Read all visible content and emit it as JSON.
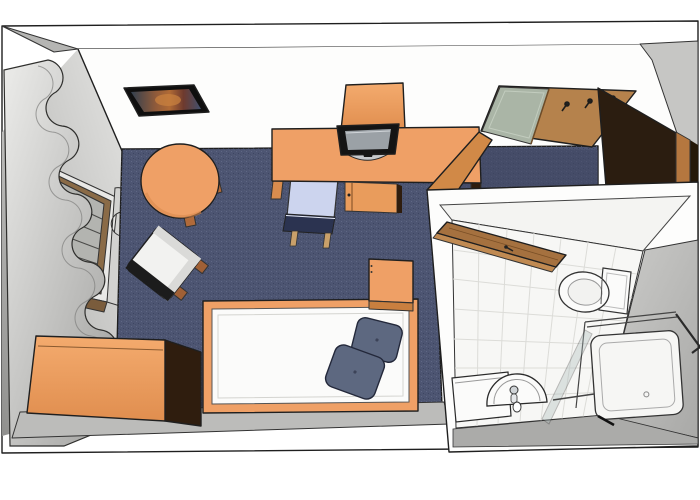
{
  "scene": {
    "title": "3D top-down floor plan render of a single room with en-suite bathroom",
    "style": "sketchup-like architectural rendering, bird's-eye perspective",
    "rooms": [
      "main-room",
      "bathroom"
    ]
  },
  "palette": {
    "outline": "#1f1f1f",
    "wall_white": "#fdfdfc",
    "wall_gray": "#c9c9c7",
    "wall_gray_dark": "#8f8f8d",
    "south_wall": "#bcbcba",
    "carpet": "#4d5572",
    "carpet_shadow": "#3f4661",
    "wood": "#efa066",
    "wood_dark": "#d18947",
    "wood_side": "#2f1d0e",
    "door_dark": "#2b1d10",
    "door_edge": "#b5773f",
    "bath_door": "#a5713f",
    "mirror_green": "#aab5a6",
    "curtain": "#d9d9d7",
    "window_frame": "#8a6b47",
    "window_glass": "#b3b4b0",
    "pillow": "#5d6880",
    "bedding": "#fbfbfa",
    "chair_seat": "#ccd4ee",
    "chair_back": "#2b3350",
    "armchair_white": "#f2f2f0",
    "armchair_band": "#1c1c1c",
    "tv_body": "#141414",
    "tv_screen": "#9ba1a6",
    "tv_base": "#c6c9cd",
    "tile": "#f7f7f5",
    "tile_line": "#dcdcd8",
    "fixture_white": "#fbfbfa",
    "picture_frame": "#0f0f0f"
  },
  "main_room": {
    "floor": "dark blue carpet",
    "items": [
      {
        "name": "wall-picture",
        "desc": "framed colorful picture on north wall"
      },
      {
        "name": "round-table",
        "desc": "round wooden table"
      },
      {
        "name": "armchair",
        "desc": "white lounge chair, rotated"
      },
      {
        "name": "window",
        "desc": "window with blinds and wavy curtains on west wall"
      },
      {
        "name": "sideboard",
        "desc": "orange chest at south-west corner"
      },
      {
        "name": "bed",
        "desc": "single bed, white bedding, two slate pillows"
      },
      {
        "name": "nightstand",
        "desc": "cube bedside table"
      },
      {
        "name": "desk",
        "desc": "long desk with TV, cabinet and shelf"
      },
      {
        "name": "desk-chair",
        "desc": "chair tucked under desk"
      },
      {
        "name": "coat-rack",
        "desc": "wall board with mirror and three hooks"
      },
      {
        "name": "luggage-bench",
        "desc": "wooden bench below coat rack"
      },
      {
        "name": "entrance-door",
        "desc": "dark brown door standing open"
      }
    ]
  },
  "bathroom": {
    "floor": "white tiles",
    "items": [
      {
        "name": "bathroom-door",
        "desc": "brown door open into bathroom"
      },
      {
        "name": "toilet",
        "desc": "toilet with tank against east wall"
      },
      {
        "name": "shower",
        "desc": "shower tray with glass cabin and open glass door"
      },
      {
        "name": "washbasin",
        "desc": "half-round basin with faucet"
      },
      {
        "name": "vanity-counter",
        "desc": "white counter left of basin"
      }
    ]
  }
}
